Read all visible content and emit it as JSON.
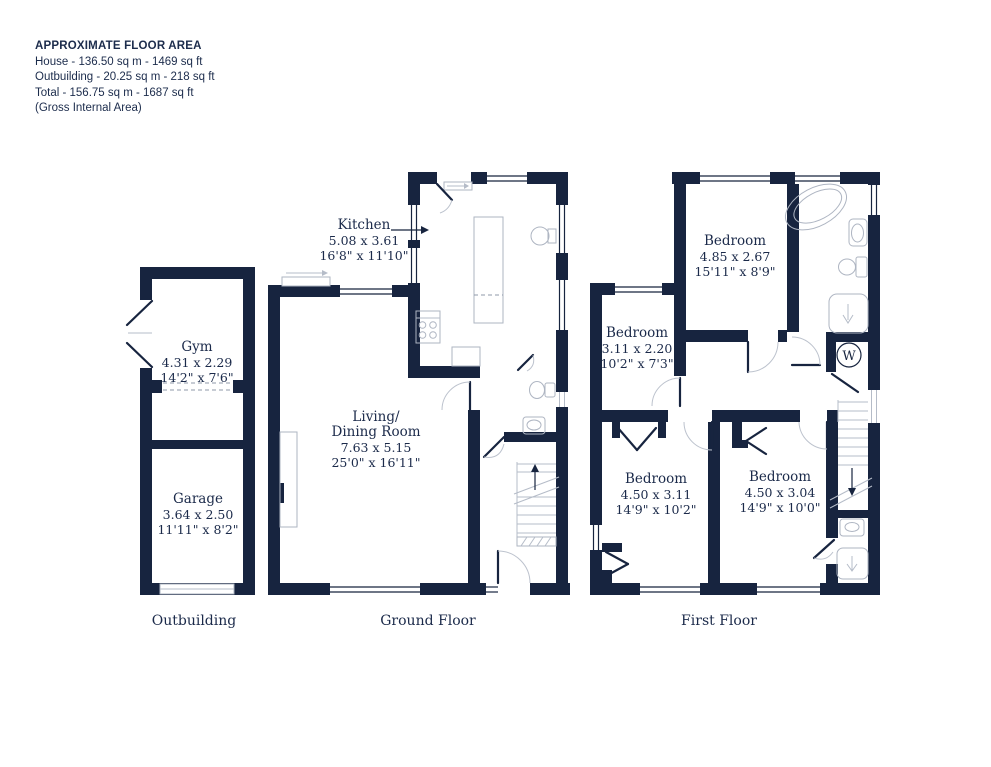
{
  "header": {
    "title": "APPROXIMATE FLOOR AREA",
    "line1": "House - 136.50 sq m - 1469 sq ft",
    "line2": "Outbuilding - 20.25 sq m - 218 sq ft",
    "line3": "Total - 156.75 sq m - 1687 sq ft",
    "line4": "(Gross Internal Area)"
  },
  "floors": {
    "outbuilding": {
      "label": "Outbuilding",
      "rooms": {
        "gym": {
          "name": "Gym",
          "metric": "4.31 x 2.29",
          "imperial": "14'2\" x 7'6\""
        },
        "garage": {
          "name": "Garage",
          "metric": "3.64 x 2.50",
          "imperial": "11'11\" x 8'2\""
        }
      }
    },
    "ground": {
      "label": "Ground Floor",
      "rooms": {
        "kitchen": {
          "name": "Kitchen",
          "metric": "5.08 x 3.61",
          "imperial": "16'8\" x 11'10\""
        },
        "living": {
          "name": "Living/",
          "name2": "Dining Room",
          "metric": "7.63 x 5.15",
          "imperial": "25'0\" x 16'11\""
        }
      }
    },
    "first": {
      "label": "First Floor",
      "rooms": {
        "bedroom1": {
          "name": "Bedroom",
          "metric": "4.85 x 2.67",
          "imperial": "15'11\" x 8'9\""
        },
        "bedroom2": {
          "name": "Bedroom",
          "metric": "3.11 x 2.20",
          "imperial": "10'2\" x 7'3\""
        },
        "bedroom3": {
          "name": "Bedroom",
          "metric": "4.50 x 3.11",
          "imperial": "14'9\" x 10'2\""
        },
        "bedroom4": {
          "name": "Bedroom",
          "metric": "4.50 x 3.04",
          "imperial": "14'9\" x 10'0\""
        }
      }
    }
  },
  "annotations": {
    "wardrobe_label": "W"
  },
  "colors": {
    "wall": "#17243f",
    "text": "#1b2a4a",
    "fixture_line": "#aeb5c2"
  }
}
